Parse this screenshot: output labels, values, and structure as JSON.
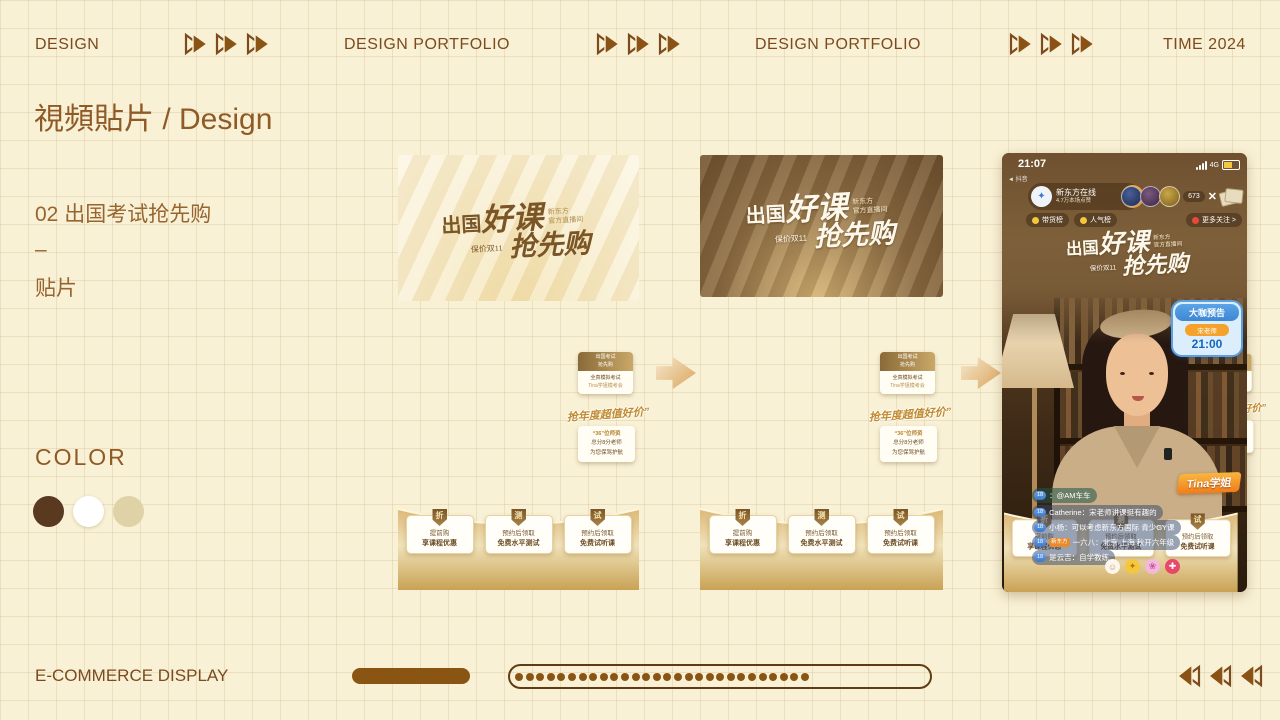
{
  "header": {
    "left": "DESIGN",
    "center1": "DESIGN PORTFOLIO",
    "center2": "DESIGN PORTFOLIO",
    "right": "TIME 2024"
  },
  "page_title": "視頻貼片 / Design",
  "section": {
    "item_no": "02 出国考试抢先购",
    "dash": "–",
    "label": "贴片"
  },
  "color_section": {
    "label": "COLOR",
    "swatches": [
      {
        "name": "dark-brown",
        "hex": "#5a3921"
      },
      {
        "name": "white",
        "hex": "#ffffff"
      },
      {
        "name": "beige",
        "hex": "#ded2a6"
      }
    ]
  },
  "banner": {
    "word1": "出国",
    "word2": "好课",
    "brand_line1": "新东方",
    "brand_line2": "官方直播间",
    "price_tag": "保价双11",
    "word3": "抢先购"
  },
  "mid_stack": {
    "note_card": {
      "header_line1": "出国考试",
      "header_line2": "抢先购",
      "body_line1": "全真模拟考试",
      "body_line2": "Tina学姐模考会"
    },
    "script_text": "抢年度超值好价”",
    "info_card": {
      "line1": "“36”位师资",
      "line2": "总分8分老师",
      "line3": "为您保驾护航"
    }
  },
  "arc_cards": [
    {
      "badge": "折",
      "line1": "提前购",
      "line2": "享课程优惠"
    },
    {
      "badge": "测",
      "line1": "预约后领取",
      "line2": "免费水平测试"
    },
    {
      "badge": "试",
      "line1": "预约后领取",
      "line2": "免费试听课"
    }
  ],
  "phone": {
    "status": {
      "time": "21:07",
      "network": "4G",
      "app_back": "抖音"
    },
    "streamer": {
      "name": "新东方在线",
      "likes": "4.7万本场点赞"
    },
    "viewer_count": "673",
    "close": "✕",
    "rank_badges": {
      "goods": "带货榜",
      "popularity": "人气榜",
      "follow": "更多关注 >"
    },
    "preview_badge": {
      "title": "大咖预告",
      "teacher": "宋老师",
      "time": "21:00"
    },
    "name_tag": "Tina学姐",
    "chat": [
      {
        "badge": "18",
        "text": "：@AM车车"
      },
      {
        "badge": "18",
        "text": "Catherine：宋老师讲课挺有趣的"
      },
      {
        "badge": "18",
        "text": "小杨：可以考虑新东方国际 青少GY课"
      },
      {
        "badge": "18",
        "vip": "新东方",
        "text": "一六八：北京 上海 秋开六年级"
      },
      {
        "badge": "18",
        "text": "是云吉：自学教练"
      }
    ],
    "emojis": [
      {
        "name": "smiley",
        "char": "☺"
      },
      {
        "name": "clap",
        "char": "✦"
      },
      {
        "name": "flower",
        "char": "❀"
      },
      {
        "name": "gift",
        "char": "✚"
      }
    ]
  },
  "footer": {
    "label": "E-COMMERCE DISPLAY",
    "dot_count": 28
  }
}
